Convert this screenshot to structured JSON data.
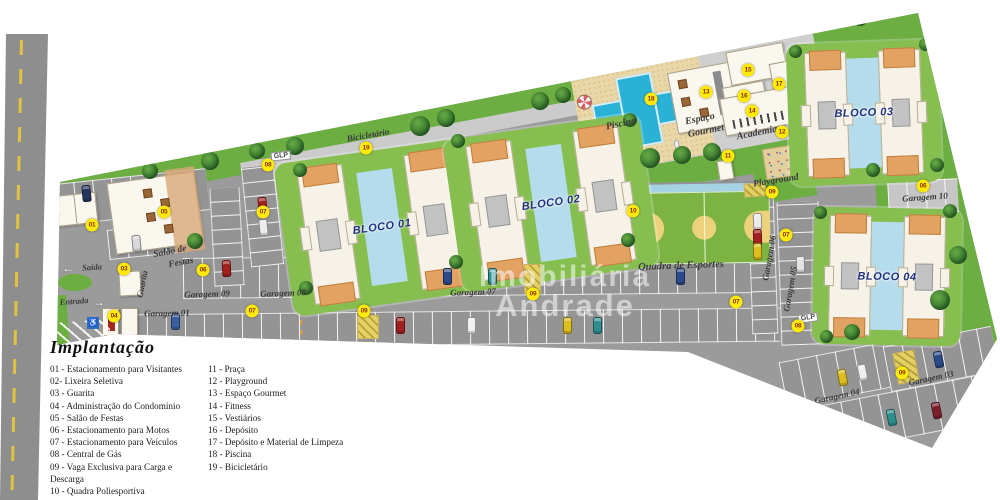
{
  "legend": {
    "title": "Implantação",
    "items_col1": [
      "01 - Estacionamento para Visitantes",
      "02- Lixeira Seletiva",
      "03 - Guarita",
      "04 - Administração do Condomínio",
      "05 - Salão de Festas",
      "06 - Estacionamento para Motos",
      "07 - Estacionamento para Veículos",
      "08 - Central de Gás",
      "09 - Vaga Exclusiva para Carga e Descarga",
      "10 - Quadra Poliesportiva"
    ],
    "items_col2": [
      "11 - Praça",
      "12 - Playground",
      "13 - Espaço Gourmet",
      "14 - Fitness",
      "15 - Vestiários",
      "16 - Depósito",
      "17 - Depósito e Material de Limpeza",
      "18 - Piscina",
      "19 - Bicicletário"
    ]
  },
  "watermark": {
    "line1": "Imobiliária",
    "line2": "Andrade"
  },
  "blocks": [
    {
      "label": "BLOCO 01"
    },
    {
      "label": "BLOCO 02"
    },
    {
      "label": "BLOCO 03"
    },
    {
      "label": "BLOCO 04"
    }
  ],
  "icons": {
    "exit_arrow": "←",
    "entrance_arrow": "→",
    "handicap": "♿"
  },
  "colors": {
    "asphalt": "#9b9b9b",
    "grass": "#6cae42",
    "block_lawn": "#86bf4f",
    "water": "#b5dcec",
    "pool": "#29b2d6",
    "sand": "#ead7a8",
    "marker": "#ffe908",
    "marker_text": "#8a2f00",
    "bloco_text": "#20307e"
  },
  "labels": [
    {
      "t": "Bicicletário",
      "x": 368,
      "y": 135,
      "r": -10,
      "s": 9
    },
    {
      "t": "Piscina",
      "x": 621,
      "y": 124,
      "r": -12,
      "s": 10
    },
    {
      "t": "Espaço",
      "x": 700,
      "y": 119,
      "r": -11,
      "s": 10
    },
    {
      "t": "Gourmet",
      "x": 706,
      "y": 131,
      "r": -11,
      "s": 10
    },
    {
      "t": "Academia",
      "x": 757,
      "y": 133,
      "r": -11,
      "s": 10
    },
    {
      "t": "Playground",
      "x": 776,
      "y": 181,
      "r": -9,
      "s": 9.5
    },
    {
      "t": "Quadra de Esportes",
      "x": 681,
      "y": 266,
      "r": -2,
      "s": 10.5
    },
    {
      "t": "Salão de",
      "x": 170,
      "y": 252,
      "r": -11,
      "s": 9.5
    },
    {
      "t": "Festas",
      "x": 181,
      "y": 263,
      "r": -11,
      "s": 9.5
    },
    {
      "t": "Guarita",
      "x": 142,
      "y": 284,
      "r": -78,
      "s": 8.5
    },
    {
      "t": "Saída",
      "x": 92,
      "y": 267,
      "r": -4,
      "s": 8.5
    },
    {
      "t": "Entrada",
      "x": 74,
      "y": 301,
      "r": -4,
      "s": 8.5
    },
    {
      "t": "Garagem 01",
      "x": 167,
      "y": 313,
      "r": -1,
      "s": 9
    },
    {
      "t": "Garagem 02",
      "x": 812,
      "y": 419,
      "r": -12,
      "s": 9
    },
    {
      "t": "Garagem 03",
      "x": 931,
      "y": 378,
      "r": -12,
      "s": 9
    },
    {
      "t": "Garagem 04",
      "x": 837,
      "y": 396,
      "r": -12,
      "s": 9
    },
    {
      "t": "Garagem 05",
      "x": 790,
      "y": 289,
      "r": -80,
      "s": 9
    },
    {
      "t": "Garagem 06",
      "x": 769,
      "y": 258,
      "r": -80,
      "s": 9
    },
    {
      "t": "Garagem 07",
      "x": 473,
      "y": 292,
      "r": -2,
      "s": 9
    },
    {
      "t": "Garagem 08",
      "x": 283,
      "y": 293,
      "r": -2,
      "s": 9
    },
    {
      "t": "Garagem 09",
      "x": 207,
      "y": 294,
      "r": -2,
      "s": 9
    },
    {
      "t": "Garagem 10",
      "x": 925,
      "y": 197,
      "r": -4,
      "s": 9
    },
    {
      "t": "GLP",
      "x": 281,
      "y": 156,
      "r": -6,
      "glp": true
    },
    {
      "t": "GLP",
      "x": 808,
      "y": 318,
      "r": -8,
      "glp": true
    }
  ],
  "markers": [
    {
      "n": "01",
      "x": 92,
      "y": 225
    },
    {
      "n": "02",
      "x": 49,
      "y": 221
    },
    {
      "n": "03",
      "x": 124,
      "y": 269
    },
    {
      "n": "04",
      "x": 114,
      "y": 316
    },
    {
      "n": "05",
      "x": 164,
      "y": 212
    },
    {
      "n": "06",
      "x": 203,
      "y": 270
    },
    {
      "n": "06",
      "x": 923,
      "y": 186
    },
    {
      "n": "07",
      "x": 263,
      "y": 212
    },
    {
      "n": "07",
      "x": 252,
      "y": 311
    },
    {
      "n": "07",
      "x": 736,
      "y": 302
    },
    {
      "n": "07",
      "x": 786,
      "y": 235
    },
    {
      "n": "08",
      "x": 268,
      "y": 165
    },
    {
      "n": "08",
      "x": 798,
      "y": 326
    },
    {
      "n": "09",
      "x": 364,
      "y": 311
    },
    {
      "n": "09",
      "x": 533,
      "y": 294
    },
    {
      "n": "09",
      "x": 772,
      "y": 192
    },
    {
      "n": "09",
      "x": 902,
      "y": 373
    },
    {
      "n": "10",
      "x": 633,
      "y": 211
    },
    {
      "n": "11",
      "x": 728,
      "y": 156
    },
    {
      "n": "12",
      "x": 782,
      "y": 132
    },
    {
      "n": "13",
      "x": 706,
      "y": 92
    },
    {
      "n": "14",
      "x": 752,
      "y": 111
    },
    {
      "n": "15",
      "x": 748,
      "y": 70
    },
    {
      "n": "16",
      "x": 744,
      "y": 96
    },
    {
      "n": "17",
      "x": 779,
      "y": 84
    },
    {
      "n": "18",
      "x": 651,
      "y": 99
    },
    {
      "n": "19",
      "x": 366,
      "y": 148
    }
  ],
  "cars": [
    [
      86,
      193,
      "#24355e",
      -6
    ],
    [
      136,
      243,
      "#d9d9d9",
      -6
    ],
    [
      262,
      205,
      "#a32020",
      -6
    ],
    [
      263,
      227,
      "#ececec",
      -6
    ],
    [
      226,
      268,
      "#a32020",
      -3
    ],
    [
      447,
      276,
      "#2b4a8b",
      0
    ],
    [
      492,
      276,
      "#2f8f8f",
      0
    ],
    [
      680,
      276,
      "#2b4a8b",
      0
    ],
    [
      175,
      321,
      "#3a5fa0",
      0
    ],
    [
      400,
      325,
      "#a32020",
      0
    ],
    [
      471,
      325,
      "#f0f0f0",
      0
    ],
    [
      567,
      325,
      "#ddbe1e",
      0
    ],
    [
      597,
      325,
      "#2f8f8f",
      0
    ],
    [
      757,
      221,
      "#ececec",
      -2
    ],
    [
      757,
      237,
      "#a32020",
      -2
    ],
    [
      757,
      251,
      "#ddbe1e",
      -2
    ],
    [
      800,
      264,
      "#e2e2e2",
      -2
    ],
    [
      842,
      377,
      "#ddbe1e",
      -11
    ],
    [
      862,
      372,
      "#f0f0f0",
      -11
    ],
    [
      938,
      359,
      "#2b4a8b",
      -11
    ],
    [
      891,
      417,
      "#2f8f8f",
      -11
    ],
    [
      936,
      410,
      "#7e1f2e",
      -11
    ]
  ],
  "trees": [
    [
      43,
      190,
      18
    ],
    [
      45,
      324,
      16
    ],
    [
      150,
      171,
      16
    ],
    [
      210,
      161,
      18
    ],
    [
      257,
      151,
      16
    ],
    [
      295,
      146,
      18
    ],
    [
      420,
      126,
      20
    ],
    [
      446,
      118,
      18
    ],
    [
      540,
      101,
      18
    ],
    [
      563,
      95,
      16
    ],
    [
      740,
      28,
      18
    ],
    [
      800,
      23,
      20
    ],
    [
      860,
      18,
      16
    ],
    [
      650,
      158,
      20
    ],
    [
      682,
      155,
      18
    ],
    [
      712,
      152,
      18
    ],
    [
      955,
      120,
      20
    ],
    [
      958,
      255,
      18
    ],
    [
      940,
      300,
      20
    ],
    [
      852,
      332,
      16
    ],
    [
      300,
      170,
      14
    ],
    [
      458,
      141,
      14
    ],
    [
      306,
      288,
      14
    ],
    [
      456,
      262,
      14
    ],
    [
      630,
      120,
      14
    ],
    [
      628,
      240,
      14
    ],
    [
      795,
      51,
      13
    ],
    [
      925,
      44,
      13
    ],
    [
      937,
      165,
      14
    ],
    [
      820,
      212,
      13
    ],
    [
      950,
      211,
      14
    ],
    [
      826,
      336,
      13
    ],
    [
      195,
      241,
      16
    ],
    [
      873,
      170,
      14
    ]
  ],
  "hatches": [
    [
      357,
      315,
      22,
      24,
      0
    ],
    [
      524,
      264,
      17,
      30,
      0
    ],
    [
      744,
      183,
      22,
      14,
      -4
    ],
    [
      895,
      351,
      22,
      32,
      -11
    ]
  ]
}
